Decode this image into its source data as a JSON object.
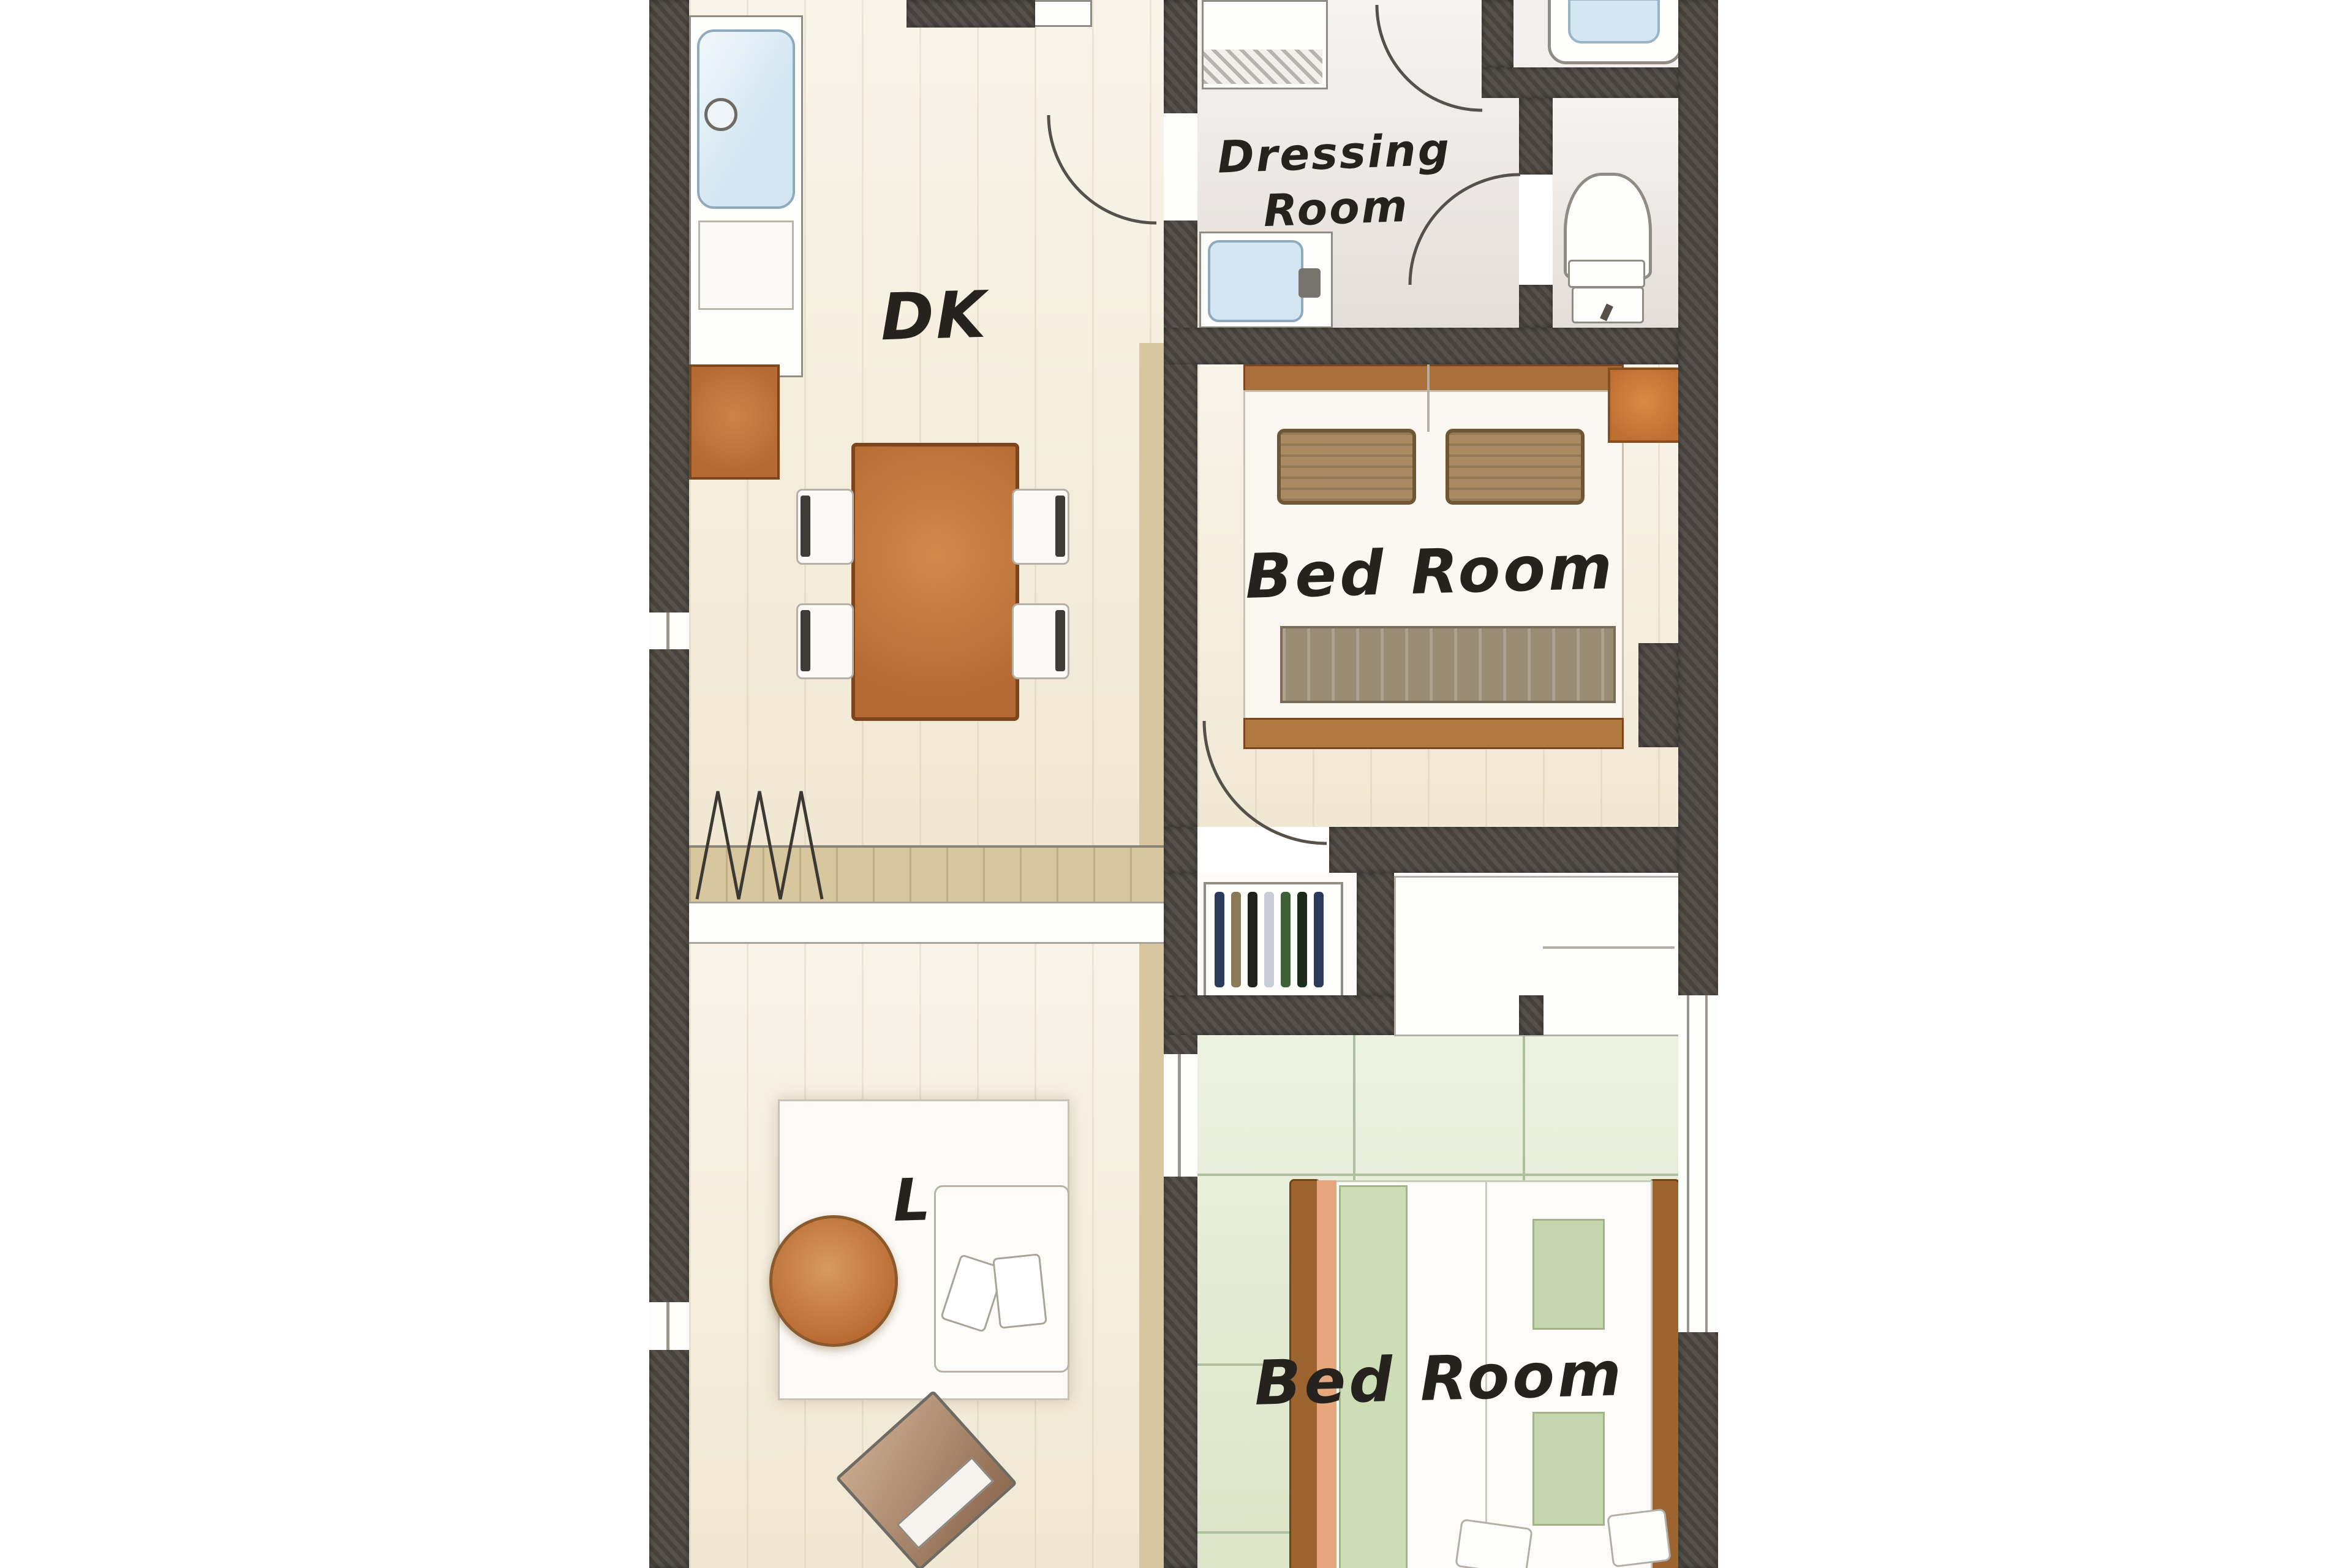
{
  "plan_title": "apartment-floor-plan",
  "rooms": {
    "dk": {
      "label": "DK"
    },
    "dressing": {
      "line1": "Dressing",
      "line2": "Room"
    },
    "bedroom1": {
      "label": "Bed Room"
    },
    "bedroom2": {
      "label": "Bed Room"
    },
    "living": {
      "label": "L"
    }
  },
  "features": {
    "kitchen": [
      "kitchen-counter",
      "kitchen-sink",
      "faucet",
      "range-hood",
      "kitchen-cabinet"
    ],
    "dining": [
      "dining-table",
      "dining-chair x4"
    ],
    "dressing_room": [
      "washing-machine",
      "vanity-sink"
    ],
    "toilet_room": [
      "toilet"
    ],
    "bathroom": [
      "bathtub"
    ],
    "bedroom1": [
      "double-bed",
      "pillow x2",
      "blanket",
      "foot-board",
      "side-cabinet"
    ],
    "closet": [
      "shelf-with-items",
      "sliding-closet"
    ],
    "bedroom2": [
      "single-bed x2",
      "futon-duvet",
      "cushion x2",
      "pillow x2",
      "tatami-grid"
    ],
    "living": [
      "rug",
      "sofa",
      "round-table",
      "tv"
    ],
    "openings": [
      "hinged-door x4",
      "folding-door-zigzag",
      "window x3",
      "sliding-door"
    ]
  },
  "palette": {
    "wall": "#4b4640",
    "floor-cream": "#f5eedd",
    "floor-gray": "#ece7e3",
    "floor-green": "#e5ecd4",
    "tatami": "#afc09c",
    "wood": "#b56a33",
    "wood-dark": "#7c451c",
    "wood-band": "#d7c69e",
    "water-blue": "#d3e6f2",
    "blue-border": "#8fa9bd",
    "outline": "#8f8b85",
    "pillow": "#a98a63",
    "blanket": "#9b8c76",
    "duvet": "#cdddb6",
    "salmon": "#e6a77d",
    "rail": "#9c6430",
    "ink": "#26231f",
    "cabinet": "#c06f33"
  }
}
